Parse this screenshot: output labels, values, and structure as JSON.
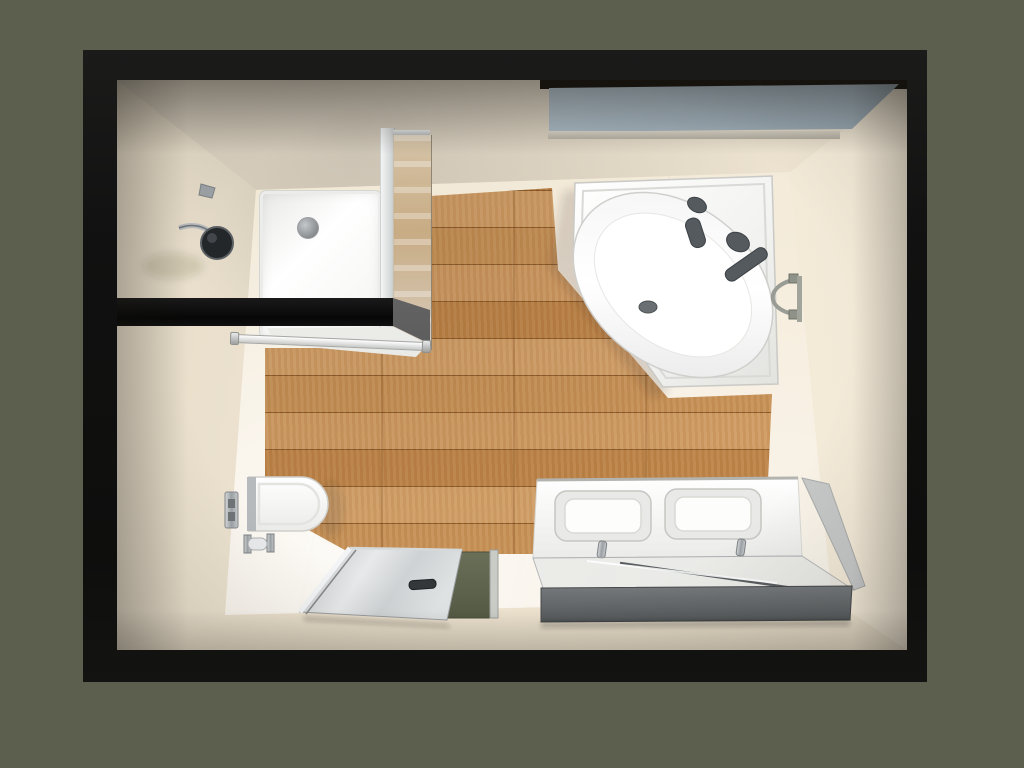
{
  "meta": {
    "title": "Photorealistic 3D render of a bathroom, top-down plan view",
    "notes": "No on-screen text; scene framed by black wall opening on olive-green backdrop"
  },
  "palette": {
    "bg-olive": "#5c5f4e",
    "frame-black": "#141414",
    "marble-light": "#f6eee0",
    "marble-mid": "#eee3d0",
    "marble-dark": "#ddd0b8",
    "floor-marble": "#f2e9d8",
    "wood-base": "#c28a50",
    "wood-light": "#d2a068",
    "wood-dark": "#a97437",
    "window-glass": "#afbec9",
    "chrome": "#a9adb0",
    "fixture-dark": "#54585c",
    "mat-olive": "#5e6350",
    "vanity-band": "#63666a",
    "pure-white": "#fbfbfa"
  },
  "scene": {
    "background": "olive-green backdrop",
    "frame": "black rectangular frame (room walls seen from above)",
    "room": {
      "walls": "cream marble tile walls",
      "floor_center": "oak wood-look plank flooring",
      "floor_border": "glossy cream marble floor tiles",
      "window": "blue-grey frosted glass window along top wall"
    },
    "fixtures": [
      {
        "name": "walk-in-shower",
        "details": "white shower tray with round drain, bronze-tinted glass screen, black half-wall, wall-mounted black shower head with chrome arm and valve, towel bar"
      },
      {
        "name": "corner-bathtub",
        "details": "white pentagonal corner tub with oval basin, dark grey deck-mounted faucet, two knobs, grab bar and drain"
      },
      {
        "name": "towel-ring",
        "details": "chrome towel ring on right wall beside tub"
      },
      {
        "name": "wall-hung-toilet",
        "details": "white wall-hung toilet with chrome flush plate and toilet-paper holder"
      },
      {
        "name": "double-vanity",
        "details": "white double washbasin unit with two chrome mixer taps, glass countertop and dark grey front band"
      },
      {
        "name": "shower-screen-and-mat",
        "details": "tilted clear glass screen with dark handle lying over an olive-green bath mat"
      }
    ]
  }
}
